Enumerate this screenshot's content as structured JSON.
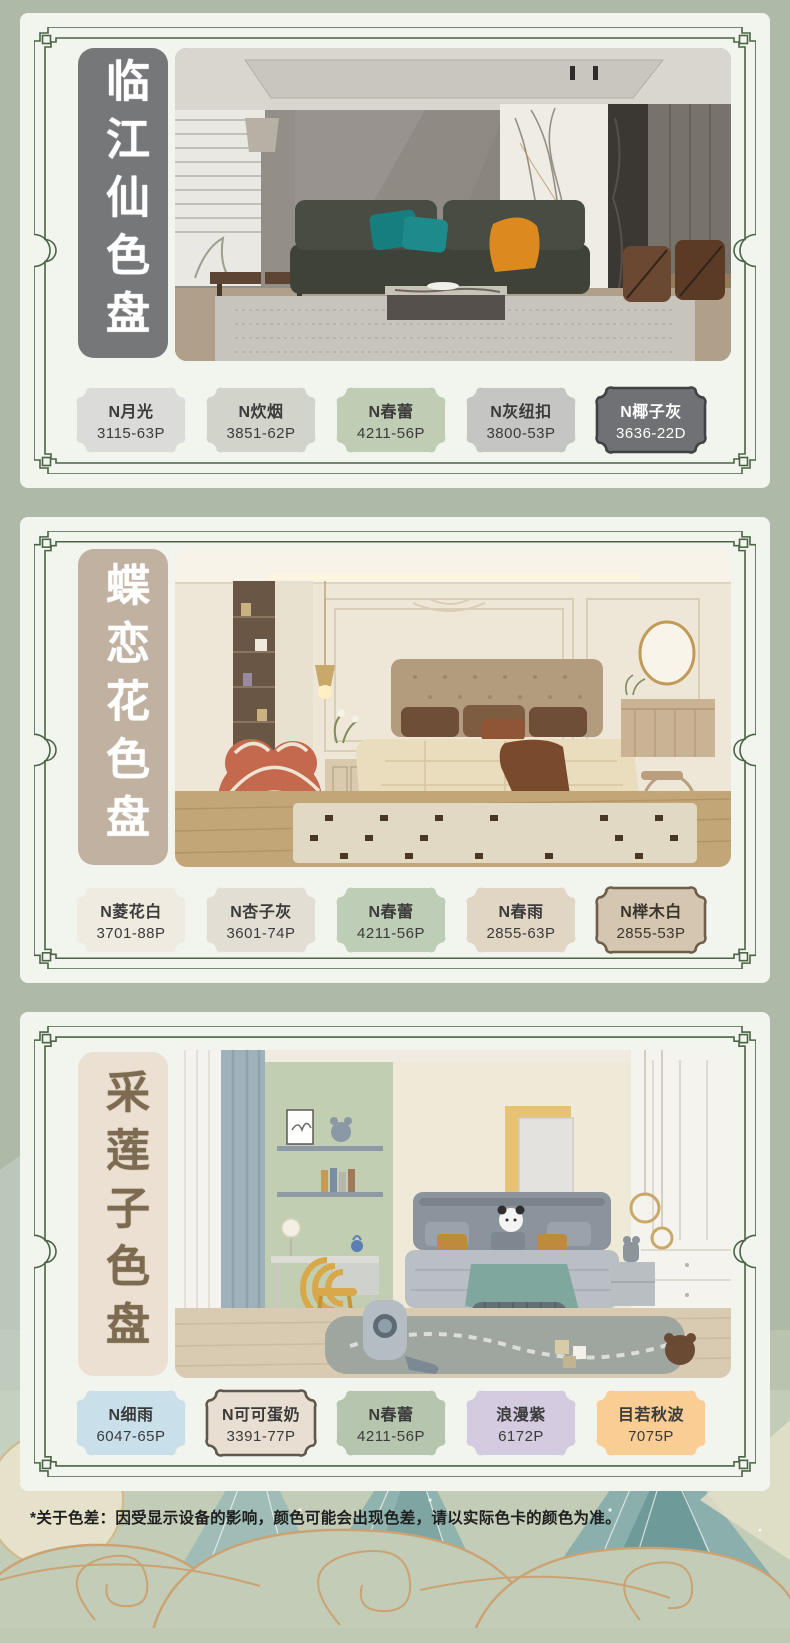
{
  "page": {
    "background": "#AEB9A8",
    "card_background": "#F2F4EE",
    "frame_color": "#4A6345",
    "footnote": "*关于色差：因受显示设备的影响，颜色可能会出现色差，请以实际色卡的颜色为准。"
  },
  "panels": [
    {
      "title": "临江仙色盘",
      "title_bg": "#767779",
      "title_color": "#FFFFFF",
      "swatches": [
        {
          "name": "N月光",
          "code": "3115-63P",
          "fill": "#DBDBD9",
          "text": "#3B3B3B"
        },
        {
          "name": "N炊烟",
          "code": "3851-62P",
          "fill": "#D2D3CB",
          "text": "#3B3B3B"
        },
        {
          "name": "N春蕾",
          "code": "4211-56P",
          "fill": "#BFCDB4",
          "text": "#3B3B3B"
        },
        {
          "name": "N灰纽扣",
          "code": "3800-53P",
          "fill": "#C5C6C3",
          "text": "#3B3B3B"
        },
        {
          "name": "N椰子灰",
          "code": "3636-22D",
          "fill": "#707174",
          "text": "#FFFFFF",
          "border": "#3F4144"
        }
      ]
    },
    {
      "title": "蝶恋花色盘",
      "title_bg": "#C0B1A1",
      "title_color": "#FFFFFF",
      "swatches": [
        {
          "name": "N菱花白",
          "code": "3701-88P",
          "fill": "#F0EBE0",
          "text": "#3B3B3B"
        },
        {
          "name": "N杏子灰",
          "code": "3601-74P",
          "fill": "#E2DED3",
          "text": "#3B3B3B"
        },
        {
          "name": "N春蕾",
          "code": "4211-56P",
          "fill": "#BECDB6",
          "text": "#3B3B3B"
        },
        {
          "name": "N春雨",
          "code": "2855-63P",
          "fill": "#E1D6C4",
          "text": "#3B3B3B"
        },
        {
          "name": "N榉木白",
          "code": "2855-53P",
          "fill": "#D4C6B1",
          "text": "#3B352C",
          "border": "#6F5D48"
        }
      ]
    },
    {
      "title": "采莲子色盘",
      "title_bg": "#EBE0D1",
      "title_color": "#7D6B51",
      "swatches": [
        {
          "name": "N细雨",
          "code": "6047-65P",
          "fill": "#C9E0EB",
          "text": "#3B3B3B"
        },
        {
          "name": "N可可蛋奶",
          "code": "3391-77P",
          "fill": "#E8DFD2",
          "text": "#3B3B3B",
          "border": "#5F564C"
        },
        {
          "name": "N春蕾",
          "code": "4211-56P",
          "fill": "#B6C5AE",
          "text": "#3B3B3B"
        },
        {
          "name": "浪漫紫",
          "code": "6172P",
          "fill": "#D4CBE0",
          "text": "#3B3B3B"
        },
        {
          "name": "目若秋波",
          "code": "7075P",
          "fill": "#F9CD94",
          "text": "#3B3B3B"
        }
      ]
    }
  ]
}
